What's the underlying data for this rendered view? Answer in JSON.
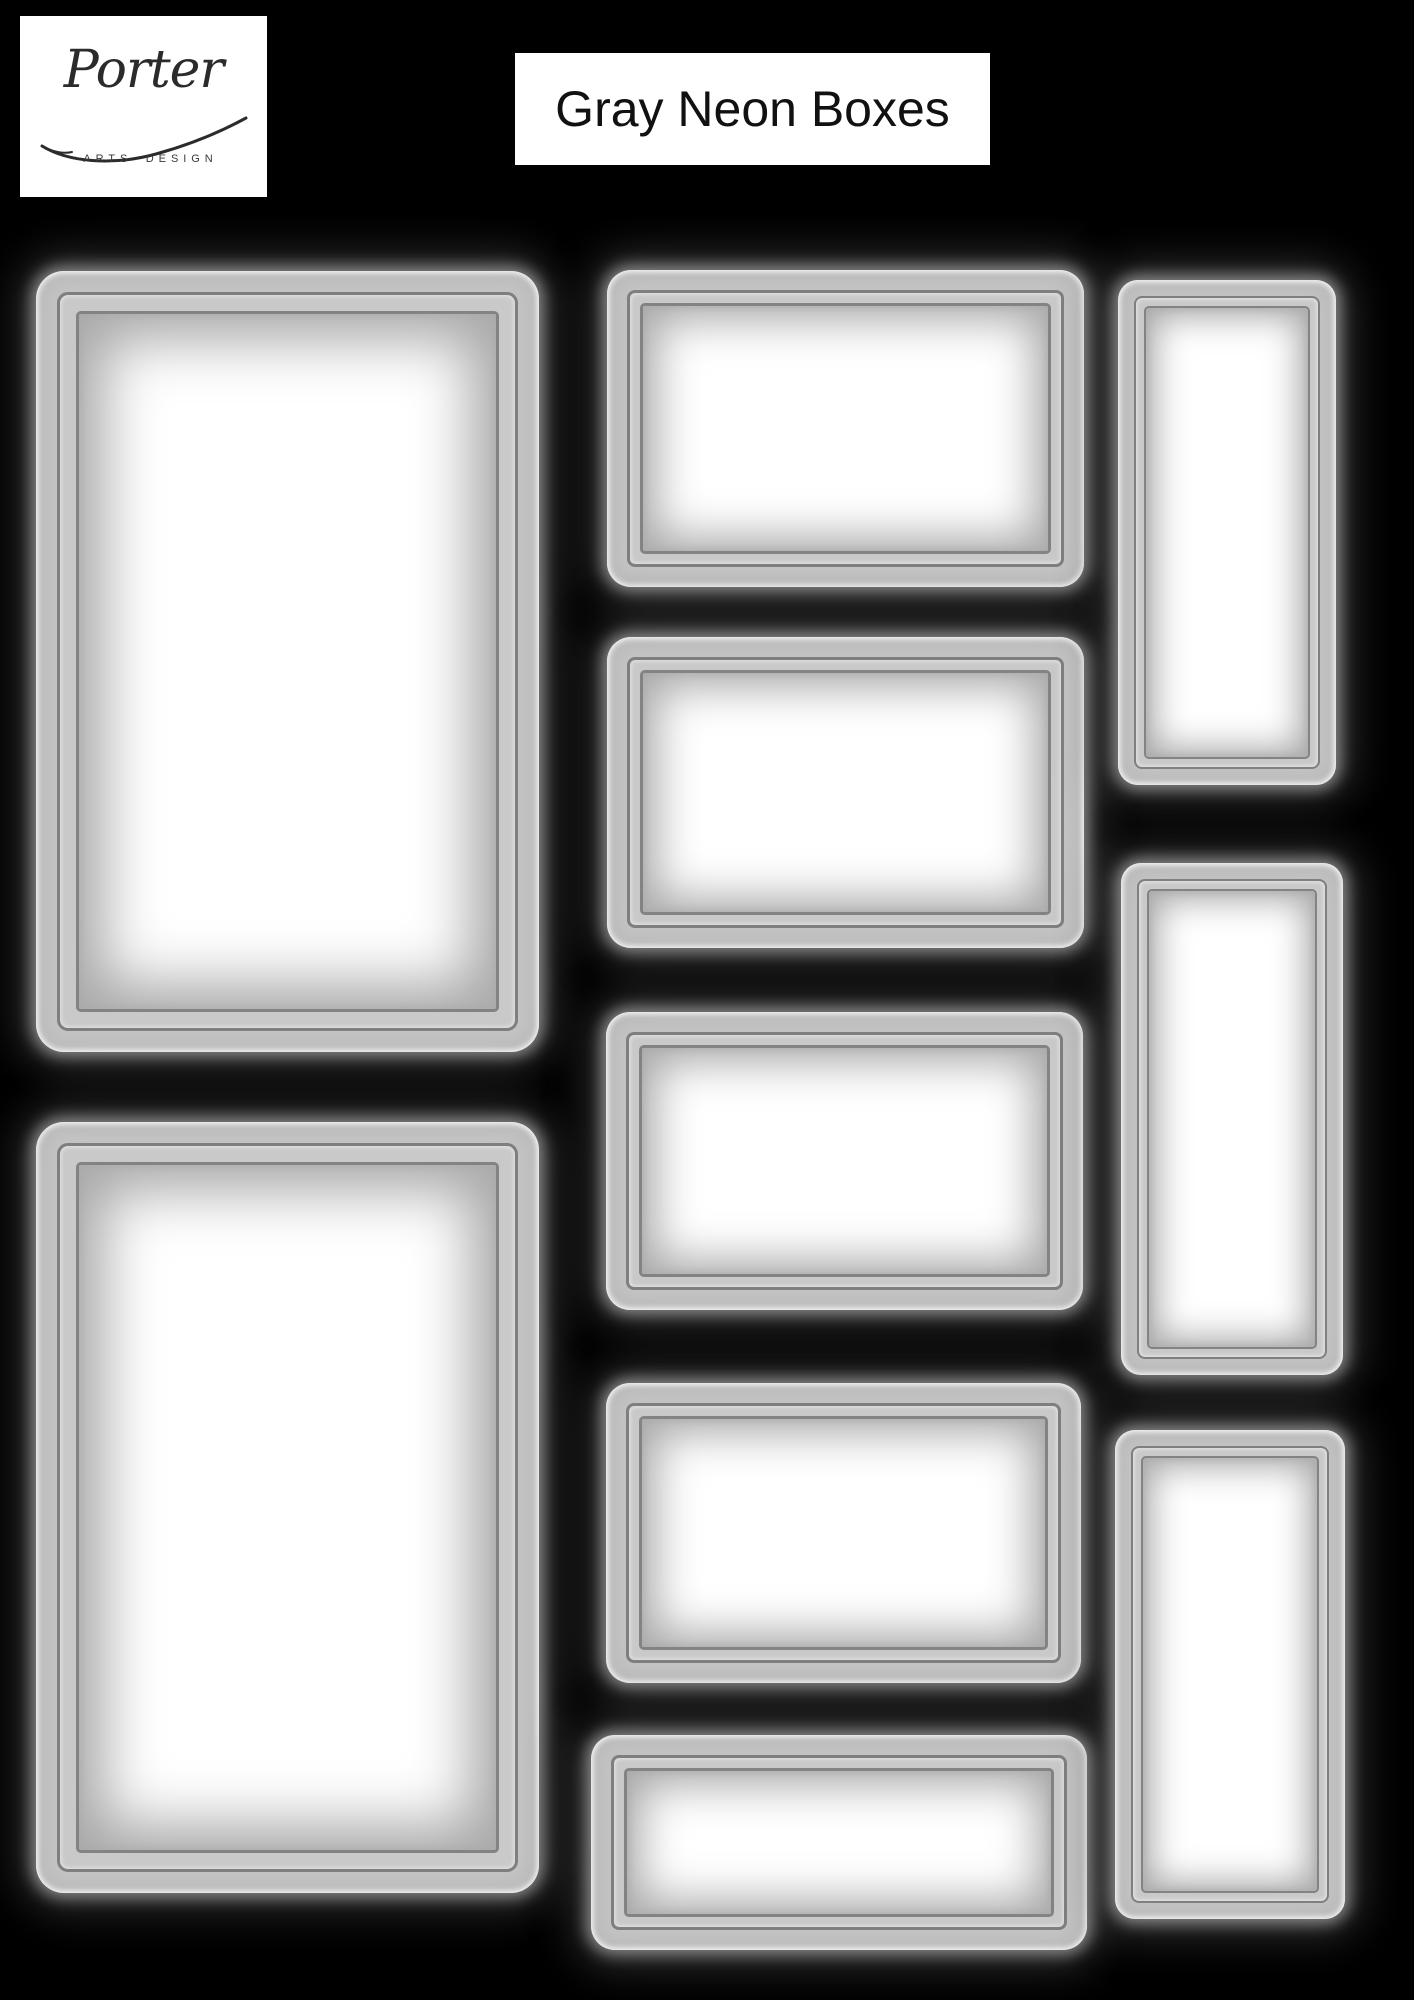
{
  "page": {
    "background": "#000000",
    "width": 1414,
    "height": 2000
  },
  "header": {
    "logo": {
      "brand": "Porter",
      "tagline": "ARTS DESIGN",
      "card_bg": "#ffffff",
      "text_color": "#2b2b2b"
    },
    "title": {
      "text": "Gray Neon Boxes",
      "card_bg": "#ffffff",
      "text_color": "#111111"
    }
  },
  "neon_style": {
    "band_color": "#c6c6c6",
    "band_highlight": "#f2f2f2",
    "ring_color": "#7f7f7f",
    "inner_ring_color": "#838383",
    "gap_band_color": "#c9c9c9",
    "bevel_shadow_color": "#a8a8a8",
    "center_color": "#ffffff",
    "glow_color_strong": "rgba(145,145,145,0.9)",
    "glow_color_soft": "rgba(95,95,95,0.5)"
  },
  "boxes": [
    {
      "id": "left-1",
      "size": "large",
      "orientation": "portrait",
      "x": 36,
      "y": 271,
      "w": 503,
      "h": 781
    },
    {
      "id": "left-2",
      "size": "large",
      "orientation": "portrait",
      "x": 36,
      "y": 1122,
      "w": 503,
      "h": 771
    },
    {
      "id": "middle-1",
      "size": "medium",
      "orientation": "landscape",
      "x": 607,
      "y": 270,
      "w": 477,
      "h": 317
    },
    {
      "id": "middle-2",
      "size": "medium",
      "orientation": "landscape",
      "x": 607,
      "y": 637,
      "w": 477,
      "h": 311
    },
    {
      "id": "middle-3",
      "size": "medium",
      "orientation": "landscape",
      "x": 606,
      "y": 1012,
      "w": 477,
      "h": 298
    },
    {
      "id": "middle-4",
      "size": "medium",
      "orientation": "landscape",
      "x": 606,
      "y": 1383,
      "w": 475,
      "h": 300
    },
    {
      "id": "middle-5",
      "size": "medium",
      "orientation": "landscape",
      "x": 591,
      "y": 1735,
      "w": 496,
      "h": 215
    },
    {
      "id": "right-1",
      "size": "small",
      "orientation": "portrait",
      "x": 1118,
      "y": 280,
      "w": 218,
      "h": 505
    },
    {
      "id": "right-2",
      "size": "small",
      "orientation": "portrait",
      "x": 1121,
      "y": 863,
      "w": 222,
      "h": 512
    },
    {
      "id": "right-3",
      "size": "small",
      "orientation": "portrait",
      "x": 1115,
      "y": 1430,
      "w": 230,
      "h": 489
    }
  ]
}
